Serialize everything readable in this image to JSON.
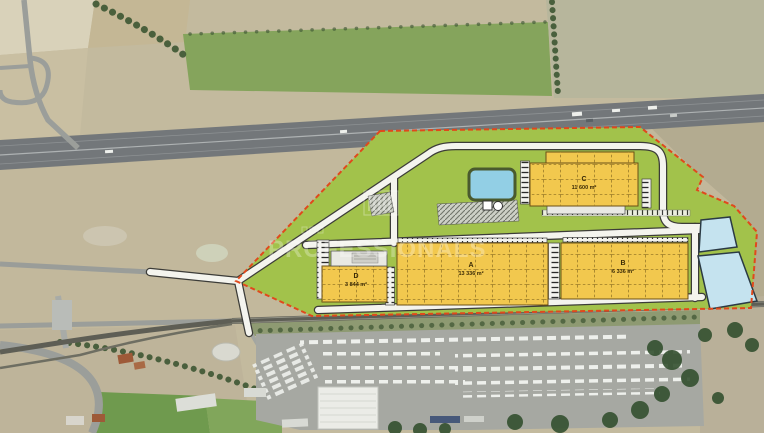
{
  "map": {
    "type": "aerial-site-plan",
    "watermark": {
      "text": "PROFESSIONALS"
    },
    "site": {
      "boundary_color": "#e0491c",
      "area_color": "#a2c24b",
      "building_color": "#f2c84e",
      "pond_color": "#92cfe5",
      "basin_color": "#c5e3ef",
      "road_color": "#f4f4ee",
      "buildings": [
        {
          "label": "A",
          "area": "13 336 m²"
        },
        {
          "label": "B",
          "area": "6 336 m²"
        },
        {
          "label": "C",
          "area": "11 600 m²"
        },
        {
          "label": "D",
          "area": "3 844 m²"
        }
      ]
    }
  }
}
